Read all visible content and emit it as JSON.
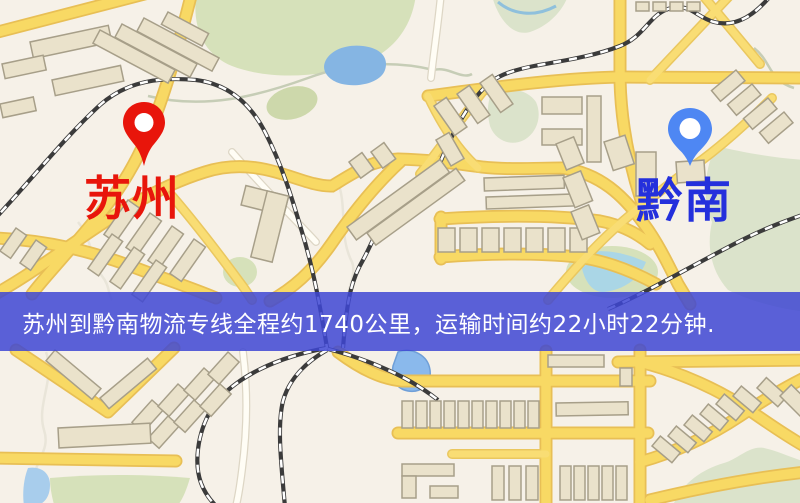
{
  "map": {
    "origin": {
      "label": "苏州",
      "pin_color": "#e8150b",
      "label_color": "#e8150b"
    },
    "destination": {
      "label": "黔南",
      "pin_color": "#4e87f3",
      "label_color": "#2430dc"
    },
    "banner": {
      "text": "苏州到黔南物流专线全程约1740公里，运输时间约22小时22分钟.",
      "background": "rgba(62,70,212,0.85)",
      "text_color": "#ffffff"
    },
    "palette": {
      "map_background": "#f6f1e8",
      "road_major": "#f8d964",
      "road_casing": "#e8bf55",
      "road_minor": "#fffdf5",
      "park_green": "#d6e1ba",
      "water_blue": "#85b5e3",
      "building_fill": "#eae2cb",
      "building_stroke": "#a79f89",
      "railway": "#3b3b3b"
    }
  }
}
